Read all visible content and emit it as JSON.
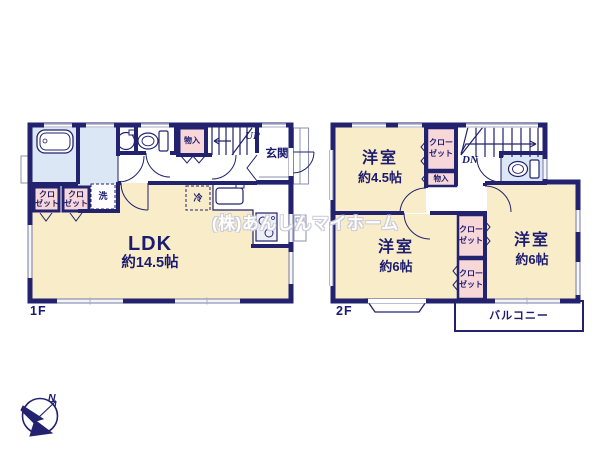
{
  "watermark": "(株)あんしんマイホーム",
  "compass": {
    "north": "N"
  },
  "floor1": {
    "label": "1F",
    "ldk_name": "LDK",
    "ldk_size": "約14.5帖",
    "genkan": "玄関",
    "monoire": "物入",
    "stairs": "UP",
    "laundry": "洗",
    "fridge": "冷",
    "closet1_l1": "クロ",
    "closet1_l2": "ゼット",
    "closet2_l1": "クロ",
    "closet2_l2": "ゼット"
  },
  "floor2": {
    "label": "2F",
    "room45_name": "洋室",
    "room45_size": "約4.5帖",
    "room6l_name": "洋室",
    "room6l_size": "約6帖",
    "room6r_name": "洋室",
    "room6r_size": "約6帖",
    "closet_top_l1": "クロー",
    "closet_top_l2": "ゼット",
    "closet_mid_l1": "クロー",
    "closet_mid_l2": "ゼット",
    "closet_bot_l1": "クロー",
    "closet_bot_l2": "ゼット",
    "monoire": "物入",
    "stairs": "DN",
    "balcony": "バルコニー"
  },
  "colors": {
    "wall": "#22226f",
    "room_cream": "#f9ecc8",
    "wet_blue": "#dbe7f4",
    "closet_pink": "#f8d7d8",
    "window_gray": "#a9aec8",
    "text": "#1b1b6f"
  }
}
